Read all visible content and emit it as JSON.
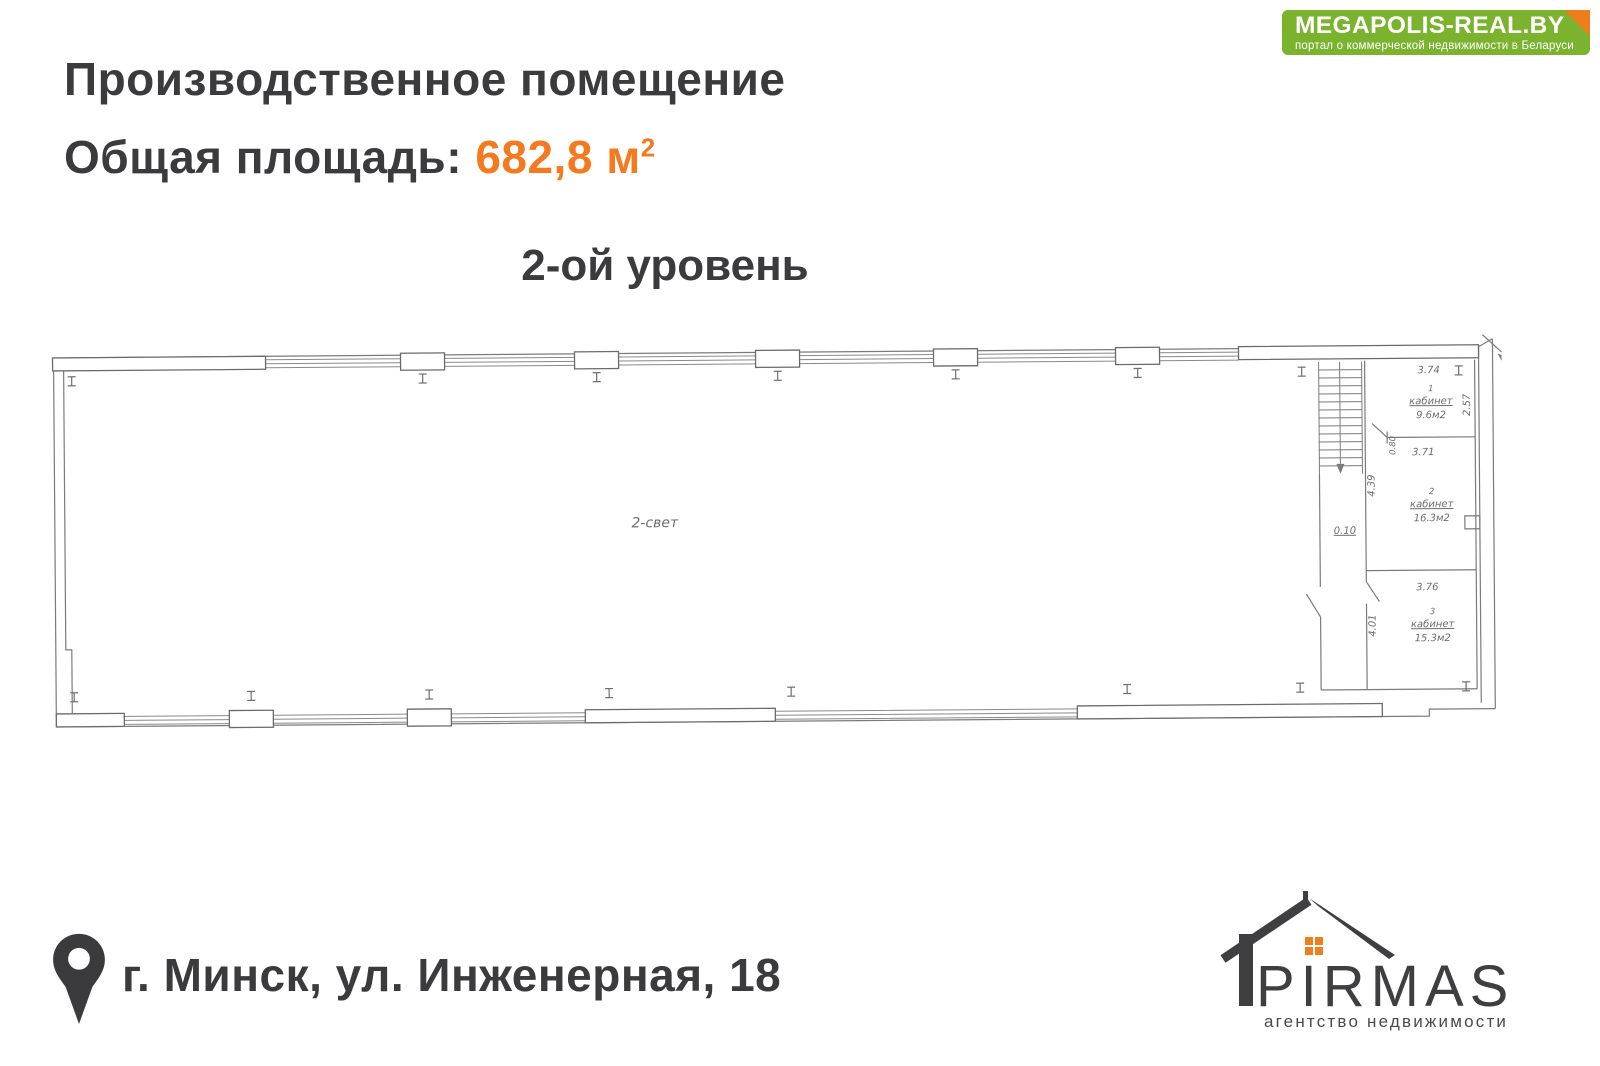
{
  "banner": {
    "title": "MEGAPOLIS-REAL.BY",
    "subtitle": "портал о коммерческой недвижимости в Беларуси"
  },
  "header": {
    "title": "Производственное помещение",
    "area_label": "Общая площадь:",
    "area_value": "682,8 м",
    "area_superscript": "2",
    "level": "2-ой уровень"
  },
  "plan": {
    "hall_label": "2-свет",
    "rooms": [
      {
        "number": "1",
        "name": "кабинет",
        "area": "9.6м2",
        "width": "3.74",
        "depth": "2.57"
      },
      {
        "number": "2",
        "name": "кабинет",
        "area": "16.3м2",
        "width": "3.71",
        "depth": "4.39"
      },
      {
        "number": "3",
        "name": "кабинет",
        "area": "15.3м2",
        "width": "3.76",
        "depth": "4.01"
      }
    ],
    "door_width": "0.80",
    "wall_step": "0.10"
  },
  "footer": {
    "address": "г. Минск, ул. Инженерная, 18"
  },
  "logo": {
    "name": "PIRMAS",
    "tagline": "агентство недвижимости"
  },
  "colors": {
    "accent_orange": "#f4791f",
    "banner_green": "#7bb32e",
    "fold_orange": "#ef7d1a",
    "text_dark": "#3b3b3d",
    "plan_line": "#7b7b7b"
  }
}
